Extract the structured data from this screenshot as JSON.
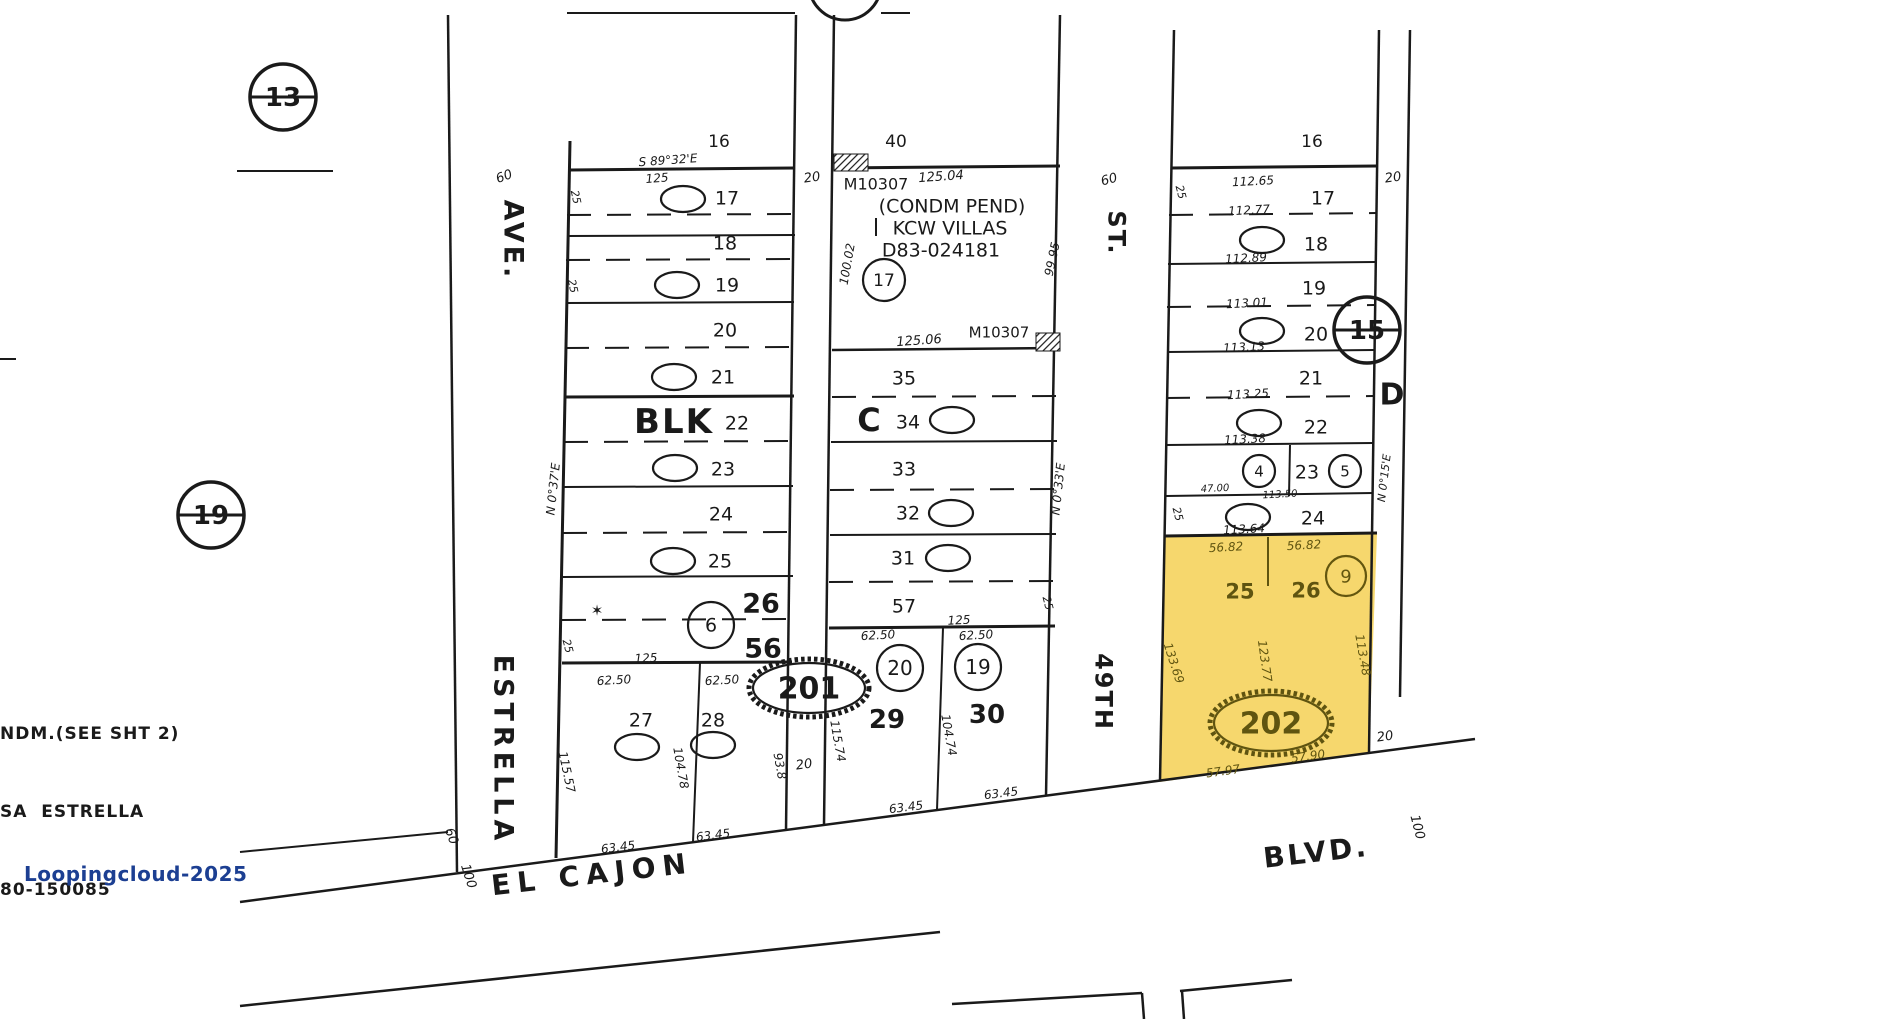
{
  "canvas": {
    "w": 1895,
    "h": 1019,
    "background": "#ffffff"
  },
  "palette": {
    "ink": "#1a1a1a",
    "highlight_fill": "#f6d76d",
    "highlight_ink": "#5f5410",
    "watermark_color": "#1c3f92"
  },
  "watermark": {
    "text": "Loopingcloud-2025"
  },
  "notes": {
    "lines": [
      "NDM.(SEE SHT 2)",
      "SA  ESTRELLA",
      "80-150085"
    ]
  },
  "highlighted_parcel": {
    "id": "202",
    "lots": [
      "25",
      "26"
    ],
    "marker": "9"
  },
  "yellow_parcel": {
    "points": [
      [
        1165,
        536
      ],
      [
        1377,
        534
      ],
      [
        1369,
        752
      ],
      [
        1160,
        782
      ]
    ]
  },
  "hatches": [
    {
      "x": 834,
      "y": 154,
      "w": 34,
      "h": 17
    },
    {
      "x": 1036,
      "y": 333,
      "w": 24,
      "h": 18
    }
  ],
  "lines": [
    [
      567,
      13,
      795,
      13,
      2,
      0
    ],
    [
      881,
      13,
      910,
      13,
      2,
      0
    ],
    [
      237,
      171,
      333,
      171,
      2,
      0
    ],
    [
      250,
      97,
      316,
      97,
      3,
      0
    ],
    [
      178,
      515,
      244,
      515,
      3,
      0
    ],
    [
      1334,
      330,
      1400,
      330,
      3,
      0
    ],
    [
      0,
      359,
      16,
      359,
      2,
      0
    ],
    [
      448,
      15,
      457,
      872,
      2.5,
      0
    ],
    [
      570,
      141,
      556,
      858,
      3,
      0
    ],
    [
      570,
      170,
      795,
      168,
      3,
      0
    ],
    [
      567,
      236,
      795,
      235,
      2,
      0
    ],
    [
      566,
      303,
      794,
      302,
      2,
      0
    ],
    [
      565,
      397,
      794,
      396,
      3,
      0
    ],
    [
      564,
      487,
      793,
      486,
      2,
      0
    ],
    [
      563,
      577,
      793,
      576,
      2,
      0
    ],
    [
      562,
      663,
      792,
      662,
      3,
      0
    ],
    [
      567,
      215,
      795,
      214,
      2,
      1
    ],
    [
      566,
      260,
      794,
      259,
      2,
      1
    ],
    [
      565,
      348,
      794,
      347,
      2,
      1
    ],
    [
      564,
      442,
      793,
      441,
      2,
      1
    ],
    [
      563,
      533,
      793,
      532,
      2,
      1
    ],
    [
      562,
      620,
      792,
      619,
      2,
      1
    ],
    [
      700,
      663,
      693,
      842,
      2,
      0
    ],
    [
      796,
      15,
      786,
      830,
      2.5,
      0
    ],
    [
      834,
      15,
      824,
      825,
      2.5,
      0
    ],
    [
      836,
      168,
      1060,
      166,
      3,
      0
    ],
    [
      1060,
      15,
      1046,
      796,
      2.5,
      0
    ],
    [
      832,
      350,
      1058,
      348,
      2.5,
      0
    ],
    [
      831,
      442,
      1057,
      441,
      2,
      0
    ],
    [
      830,
      535,
      1056,
      534,
      2,
      0
    ],
    [
      829,
      628,
      1055,
      626,
      3,
      0
    ],
    [
      832,
      397,
      1058,
      396,
      2,
      1
    ],
    [
      830,
      490,
      1056,
      489,
      2,
      1
    ],
    [
      829,
      582,
      1055,
      581,
      2,
      1
    ],
    [
      943,
      628,
      937,
      810,
      2,
      0
    ],
    [
      876,
      218,
      876,
      236,
      2,
      0
    ],
    [
      1174,
      30,
      1160,
      781,
      2.5,
      0
    ],
    [
      1172,
      168,
      1377,
      166,
      3,
      0
    ],
    [
      1379,
      30,
      1369,
      753,
      2.5,
      0
    ],
    [
      1410,
      30,
      1400,
      697,
      2.5,
      0
    ],
    [
      1168,
      264,
      1375,
      262,
      2,
      0
    ],
    [
      1167,
      352,
      1374,
      350,
      2,
      0
    ],
    [
      1166,
      445,
      1373,
      443,
      2,
      0
    ],
    [
      1166,
      496,
      1373,
      493,
      2,
      0
    ],
    [
      1165,
      536,
      1377,
      533,
      3,
      0
    ],
    [
      1169,
      215,
      1376,
      213,
      2,
      1
    ],
    [
      1167,
      307,
      1374,
      305,
      2,
      1
    ],
    [
      1166,
      398,
      1373,
      396,
      2,
      1
    ],
    [
      1290,
      445,
      1289,
      496,
      2,
      0
    ],
    [
      1268,
      537,
      1268,
      586,
      2,
      0,
      "#5f5410"
    ],
    [
      240,
      902,
      1475,
      739,
      2.5,
      0
    ],
    [
      240,
      1006,
      940,
      932,
      2.5,
      0
    ],
    [
      952,
      1004,
      1142,
      993,
      2.5,
      0
    ],
    [
      1142,
      993,
      1144,
      1019,
      2.5,
      0
    ],
    [
      1180,
      991,
      1292,
      980,
      2.5,
      0
    ],
    [
      1182,
      991,
      1184,
      1019,
      2.5,
      0
    ],
    [
      240,
      852,
      448,
      832,
      2,
      0
    ]
  ],
  "ellipses": [
    {
      "t": "1",
      "x": 683,
      "y": 199
    },
    {
      "t": "2",
      "x": 677,
      "y": 285
    },
    {
      "t": "3",
      "x": 674,
      "y": 377
    },
    {
      "t": "4",
      "x": 675,
      "y": 468
    },
    {
      "t": "5",
      "x": 673,
      "y": 561
    },
    {
      "t": "6",
      "x": 711,
      "y": 625,
      "rx": 23,
      "ry": 23,
      "fs": 19
    },
    {
      "t": "7",
      "x": 637,
      "y": 747
    },
    {
      "t": "8",
      "x": 713,
      "y": 745
    },
    {
      "t": "17",
      "x": 884,
      "y": 280,
      "rx": 21,
      "ry": 21,
      "fs": 17
    },
    {
      "t": "13",
      "x": 952,
      "y": 420
    },
    {
      "t": "12",
      "x": 951,
      "y": 513
    },
    {
      "t": "11",
      "x": 948,
      "y": 558
    },
    {
      "t": "20",
      "x": 900,
      "y": 668,
      "rx": 23,
      "ry": 23,
      "fs": 20
    },
    {
      "t": "19",
      "x": 978,
      "y": 667,
      "rx": 23,
      "ry": 23,
      "fs": 20
    },
    {
      "t": "1",
      "x": 1262,
      "y": 240
    },
    {
      "t": "2",
      "x": 1262,
      "y": 331
    },
    {
      "t": "3",
      "x": 1259,
      "y": 423
    },
    {
      "t": "4",
      "x": 1259,
      "y": 471,
      "rx": 16,
      "ry": 16,
      "fs": 15
    },
    {
      "t": "5",
      "x": 1345,
      "y": 471,
      "rx": 16,
      "ry": 16,
      "fs": 15
    },
    {
      "t": "6",
      "x": 1248,
      "y": 517
    },
    {
      "t": "9",
      "x": 1346,
      "y": 576,
      "rx": 20,
      "ry": 20,
      "fs": 18,
      "c": "#63560f"
    },
    {
      "t": "13",
      "x": 283,
      "y": 97,
      "rx": 33,
      "ry": 33,
      "fs": 26,
      "b": 1,
      "sw": 3.5,
      "n": "ref-circle-13"
    },
    {
      "t": "19",
      "x": 211,
      "y": 515,
      "rx": 33,
      "ry": 33,
      "fs": 26,
      "b": 1,
      "sw": 3.5,
      "n": "ref-circle-19"
    },
    {
      "t": "15",
      "x": 1367,
      "y": 330,
      "rx": 33,
      "ry": 33,
      "fs": 26,
      "b": 1,
      "sw": 3.5,
      "n": "ref-circle-15"
    },
    {
      "t": "",
      "x": 845,
      "y": -16,
      "rx": 36,
      "ry": 36,
      "fs": 0,
      "sw": 3,
      "n": "ref-circle-partial"
    },
    {
      "t": "201",
      "x": 809,
      "y": 688,
      "rx": 56,
      "ry": 25,
      "fs": 30,
      "b": 1,
      "h": 1,
      "n": "parcel-oval-201"
    },
    {
      "t": "202",
      "x": 1271,
      "y": 723,
      "rx": 57,
      "ry": 28,
      "fs": 30,
      "b": 1,
      "h": 1,
      "c": "#5f5410",
      "n": "parcel-oval-202"
    }
  ],
  "labels": [
    {
      "t": "AVE.",
      "x": 514,
      "y": 240,
      "fs": 27,
      "rot": 90,
      "ls": 3,
      "b": 1,
      "n": "street-label-estrella-ave"
    },
    {
      "t": "ESTRELLA",
      "x": 504,
      "y": 750,
      "fs": 27,
      "rot": 90,
      "ls": 5,
      "b": 1,
      "n": "street-label-estrella"
    },
    {
      "t": "ST.",
      "x": 1117,
      "y": 233,
      "fs": 24,
      "rot": 90,
      "ls": 2,
      "b": 1,
      "n": "street-label-49th-st"
    },
    {
      "t": "49TH",
      "x": 1104,
      "y": 692,
      "fs": 24,
      "rot": 90,
      "ls": 2,
      "b": 1,
      "n": "street-label-49th"
    },
    {
      "t": "EL CAJON",
      "x": 592,
      "y": 874,
      "fs": 28,
      "rot": -6.5,
      "ls": 7,
      "b": 1,
      "n": "street-label-el-cajon"
    },
    {
      "t": "BLVD.",
      "x": 1316,
      "y": 852,
      "fs": 28,
      "rot": -6.5,
      "ls": 3,
      "b": 1,
      "n": "street-label-blvd"
    },
    {
      "t": "60",
      "x": 504,
      "y": 176,
      "fs": 13,
      "rot": -20,
      "it": 1
    },
    {
      "t": "60",
      "x": 452,
      "y": 836,
      "fs": 13,
      "rot": 70,
      "it": 1
    },
    {
      "t": "60",
      "x": 1109,
      "y": 179,
      "fs": 13,
      "rot": -15,
      "it": 1
    },
    {
      "t": "100",
      "x": 469,
      "y": 876,
      "fs": 13,
      "rot": 72,
      "it": 1
    },
    {
      "t": "100",
      "x": 1418,
      "y": 827,
      "fs": 13,
      "rot": 75,
      "it": 1
    },
    {
      "t": "20",
      "x": 812,
      "y": 177,
      "fs": 13,
      "rot": -8,
      "it": 1
    },
    {
      "t": "20",
      "x": 804,
      "y": 764,
      "fs": 13,
      "rot": -8,
      "it": 1
    },
    {
      "t": "20",
      "x": 1393,
      "y": 177,
      "fs": 13,
      "rot": -8,
      "it": 1
    },
    {
      "t": "20",
      "x": 1385,
      "y": 736,
      "fs": 13,
      "rot": -8,
      "it": 1
    },
    {
      "t": "D",
      "x": 1392,
      "y": 394,
      "fs": 30,
      "b": 1,
      "n": "block-label-d"
    },
    {
      "t": "16",
      "x": 719,
      "y": 141,
      "fs": 17
    },
    {
      "t": "S 89°32'E",
      "x": 668,
      "y": 160,
      "fs": 12,
      "it": 1,
      "rot": -4,
      "n": "bearing-label"
    },
    {
      "t": "125",
      "x": 657,
      "y": 178,
      "fs": 12,
      "it": 1,
      "rot": -4
    },
    {
      "t": "25",
      "x": 576,
      "y": 197,
      "fs": 11,
      "it": 1,
      "rot": 78
    },
    {
      "t": "25",
      "x": 573,
      "y": 286,
      "fs": 11,
      "it": 1,
      "rot": 78
    },
    {
      "t": "N 0°37'E",
      "x": 553,
      "y": 489,
      "fs": 12,
      "it": 1,
      "rot": -84,
      "n": "bearing-label"
    },
    {
      "t": "25",
      "x": 568,
      "y": 646,
      "fs": 11,
      "it": 1,
      "rot": 75
    },
    {
      "t": "17",
      "x": 727,
      "y": 198,
      "fs": 19
    },
    {
      "t": "18",
      "x": 725,
      "y": 243,
      "fs": 19
    },
    {
      "t": "19",
      "x": 727,
      "y": 285,
      "fs": 19
    },
    {
      "t": "20",
      "x": 725,
      "y": 330,
      "fs": 19
    },
    {
      "t": "21",
      "x": 723,
      "y": 377,
      "fs": 19
    },
    {
      "t": "BLK",
      "x": 674,
      "y": 421,
      "fs": 34,
      "ls": 2,
      "b": 1,
      "n": "block-label-blk"
    },
    {
      "t": "22",
      "x": 737,
      "y": 423,
      "fs": 19
    },
    {
      "t": "23",
      "x": 723,
      "y": 469,
      "fs": 19
    },
    {
      "t": "24",
      "x": 721,
      "y": 514,
      "fs": 19
    },
    {
      "t": "25",
      "x": 720,
      "y": 561,
      "fs": 19
    },
    {
      "t": "26",
      "x": 761,
      "y": 603,
      "fs": 27,
      "b": 1
    },
    {
      "t": "56",
      "x": 763,
      "y": 648,
      "fs": 27,
      "b": 1
    },
    {
      "t": "✶",
      "x": 597,
      "y": 610,
      "fs": 15,
      "n": "monument-star-icon"
    },
    {
      "t": "125",
      "x": 646,
      "y": 658,
      "fs": 12,
      "it": 1,
      "rot": -3
    },
    {
      "t": "62.50",
      "x": 614,
      "y": 680,
      "fs": 12,
      "it": 1,
      "rot": -3
    },
    {
      "t": "62.50",
      "x": 722,
      "y": 680,
      "fs": 12,
      "it": 1,
      "rot": -3
    },
    {
      "t": "27",
      "x": 641,
      "y": 720,
      "fs": 19
    },
    {
      "t": "28",
      "x": 713,
      "y": 720,
      "fs": 19
    },
    {
      "t": "115.57",
      "x": 567,
      "y": 772,
      "fs": 12,
      "it": 1,
      "rot": 78
    },
    {
      "t": "104.78",
      "x": 681,
      "y": 768,
      "fs": 12,
      "it": 1,
      "rot": 80
    },
    {
      "t": "93.8",
      "x": 780,
      "y": 766,
      "fs": 12,
      "it": 1,
      "rot": 80
    },
    {
      "t": "63.45",
      "x": 618,
      "y": 847,
      "fs": 12,
      "it": 1,
      "rot": -7
    },
    {
      "t": "63.45",
      "x": 713,
      "y": 835,
      "fs": 12,
      "it": 1,
      "rot": -7
    },
    {
      "t": "40",
      "x": 896,
      "y": 141,
      "fs": 17
    },
    {
      "t": "M10307",
      "x": 876,
      "y": 184,
      "fs": 16
    },
    {
      "t": "125.04",
      "x": 941,
      "y": 176,
      "fs": 13,
      "it": 1,
      "rot": -4
    },
    {
      "t": "(CONDM PEND)",
      "x": 952,
      "y": 206,
      "fs": 19,
      "n": "condo-pending-note"
    },
    {
      "t": "KCW VILLAS",
      "x": 950,
      "y": 228,
      "fs": 19,
      "n": "subdivision-name"
    },
    {
      "t": "D83-024181",
      "x": 941,
      "y": 250,
      "fs": 19,
      "n": "document-number"
    },
    {
      "t": "100.02",
      "x": 847,
      "y": 264,
      "fs": 12,
      "it": 1,
      "rot": -80
    },
    {
      "t": "99.95",
      "x": 1052,
      "y": 259,
      "fs": 12,
      "it": 1,
      "rot": -78
    },
    {
      "t": "125.06",
      "x": 919,
      "y": 340,
      "fs": 13,
      "it": 1,
      "rot": -4
    },
    {
      "t": "M10307",
      "x": 999,
      "y": 332,
      "fs": 15
    },
    {
      "t": "35",
      "x": 904,
      "y": 378,
      "fs": 19
    },
    {
      "t": "C",
      "x": 869,
      "y": 420,
      "fs": 32,
      "b": 1,
      "n": "block-label-c"
    },
    {
      "t": "34",
      "x": 908,
      "y": 422,
      "fs": 19
    },
    {
      "t": "33",
      "x": 904,
      "y": 469,
      "fs": 19
    },
    {
      "t": "32",
      "x": 908,
      "y": 513,
      "fs": 19
    },
    {
      "t": "31",
      "x": 903,
      "y": 558,
      "fs": 19
    },
    {
      "t": "57",
      "x": 904,
      "y": 606,
      "fs": 19
    },
    {
      "t": "125",
      "x": 959,
      "y": 620,
      "fs": 12,
      "it": 1,
      "rot": -3
    },
    {
      "t": "62.50",
      "x": 878,
      "y": 635,
      "fs": 12,
      "it": 1,
      "rot": -3
    },
    {
      "t": "62.50",
      "x": 976,
      "y": 635,
      "fs": 12,
      "it": 1,
      "rot": -3
    },
    {
      "t": "29",
      "x": 887,
      "y": 719,
      "fs": 26,
      "b": 1
    },
    {
      "t": "30",
      "x": 987,
      "y": 714,
      "fs": 26,
      "b": 1
    },
    {
      "t": "115.74",
      "x": 838,
      "y": 741,
      "fs": 12,
      "it": 1,
      "rot": 80
    },
    {
      "t": "104.74",
      "x": 949,
      "y": 735,
      "fs": 12,
      "it": 1,
      "rot": 80
    },
    {
      "t": "63.45",
      "x": 906,
      "y": 807,
      "fs": 12,
      "it": 1,
      "rot": -7
    },
    {
      "t": "63.45",
      "x": 1001,
      "y": 793,
      "fs": 12,
      "it": 1,
      "rot": -7
    },
    {
      "t": "N 0°33'E",
      "x": 1058,
      "y": 489,
      "fs": 12,
      "it": 1,
      "rot": -84,
      "n": "bearing-label"
    },
    {
      "t": "25",
      "x": 1048,
      "y": 603,
      "fs": 11,
      "it": 1,
      "rot": 75
    },
    {
      "t": "16",
      "x": 1312,
      "y": 141,
      "fs": 17
    },
    {
      "t": "25",
      "x": 1181,
      "y": 192,
      "fs": 11,
      "it": 1,
      "rot": 75
    },
    {
      "t": "112.65",
      "x": 1253,
      "y": 181,
      "fs": 12,
      "it": 1,
      "rot": -3
    },
    {
      "t": "17",
      "x": 1323,
      "y": 198,
      "fs": 19
    },
    {
      "t": "112.77",
      "x": 1249,
      "y": 210,
      "fs": 12,
      "it": 1,
      "rot": -3
    },
    {
      "t": "18",
      "x": 1316,
      "y": 244,
      "fs": 19
    },
    {
      "t": "112.89",
      "x": 1246,
      "y": 258,
      "fs": 12,
      "it": 1,
      "rot": -3
    },
    {
      "t": "19",
      "x": 1314,
      "y": 288,
      "fs": 19
    },
    {
      "t": "113.01",
      "x": 1247,
      "y": 303,
      "fs": 12,
      "it": 1,
      "rot": -3
    },
    {
      "t": "20",
      "x": 1316,
      "y": 334,
      "fs": 19
    },
    {
      "t": "113.13",
      "x": 1244,
      "y": 347,
      "fs": 12,
      "it": 1,
      "rot": -3
    },
    {
      "t": "21",
      "x": 1311,
      "y": 378,
      "fs": 19
    },
    {
      "t": "113.25",
      "x": 1248,
      "y": 394,
      "fs": 12,
      "it": 1,
      "rot": -3
    },
    {
      "t": "22",
      "x": 1316,
      "y": 427,
      "fs": 19
    },
    {
      "t": "113.38",
      "x": 1245,
      "y": 439,
      "fs": 12,
      "it": 1,
      "rot": -3
    },
    {
      "t": "23",
      "x": 1307,
      "y": 472,
      "fs": 19
    },
    {
      "t": "47.00",
      "x": 1215,
      "y": 488,
      "fs": 10,
      "it": 1,
      "rot": -3
    },
    {
      "t": "113.50",
      "x": 1280,
      "y": 494,
      "fs": 10,
      "it": 1,
      "rot": -3
    },
    {
      "t": "25",
      "x": 1178,
      "y": 514,
      "fs": 11,
      "it": 1,
      "rot": 75
    },
    {
      "t": "24",
      "x": 1313,
      "y": 518,
      "fs": 19
    },
    {
      "t": "113.64",
      "x": 1244,
      "y": 529,
      "fs": 12,
      "it": 1,
      "rot": -3
    },
    {
      "t": "N 0°15'E",
      "x": 1384,
      "y": 478,
      "fs": 11,
      "it": 1,
      "rot": -83,
      "n": "bearing-label"
    },
    {
      "t": "56.82",
      "x": 1226,
      "y": 547,
      "fs": 12,
      "it": 1,
      "rot": -3,
      "c": "#5f5410"
    },
    {
      "t": "56.82",
      "x": 1304,
      "y": 545,
      "fs": 12,
      "it": 1,
      "rot": -3,
      "c": "#5f5410"
    },
    {
      "t": "25",
      "x": 1240,
      "y": 591,
      "fs": 21,
      "b": 1,
      "c": "#5f5410"
    },
    {
      "t": "26",
      "x": 1306,
      "y": 590,
      "fs": 21,
      "b": 1,
      "c": "#5f5410"
    },
    {
      "t": "123.77",
      "x": 1265,
      "y": 661,
      "fs": 12,
      "it": 1,
      "rot": 82,
      "c": "#5f5410"
    },
    {
      "t": "133.69",
      "x": 1174,
      "y": 663,
      "fs": 12,
      "it": 1,
      "rot": 72,
      "c": "#5f5410"
    },
    {
      "t": "113.48",
      "x": 1363,
      "y": 655,
      "fs": 12,
      "it": 1,
      "rot": 80,
      "c": "#5f5410"
    },
    {
      "t": "57.97",
      "x": 1223,
      "y": 771,
      "fs": 12,
      "it": 1,
      "rot": -8,
      "c": "#5f5410"
    },
    {
      "t": "57.90",
      "x": 1308,
      "y": 756,
      "fs": 12,
      "it": 1,
      "rot": -8,
      "c": "#5f5410"
    }
  ]
}
